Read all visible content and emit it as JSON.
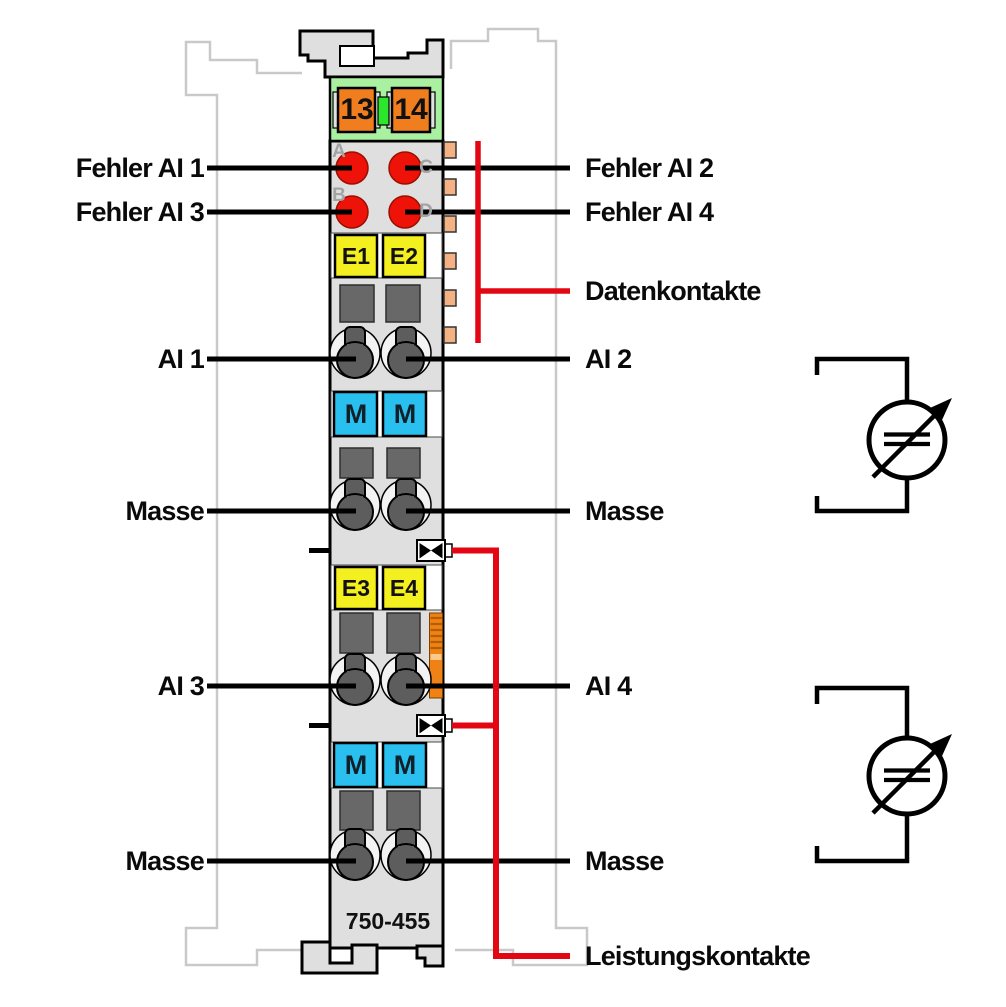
{
  "diagram": {
    "title_part_number": "750-455",
    "left_labels": {
      "fehler_ai_1": "Fehler AI 1",
      "fehler_ai_3": "Fehler AI 3",
      "ai_1": "AI 1",
      "masse_1": "Masse",
      "ai_3": "AI 3",
      "masse_2": "Masse"
    },
    "right_labels": {
      "fehler_ai_2": "Fehler AI 2",
      "fehler_ai_4": "Fehler AI 4",
      "datenkontakte": "Datenkontakte",
      "ai_2": "AI 2",
      "masse_1": "Masse",
      "ai_4": "AI 4",
      "masse_2": "Masse",
      "leistungskontakte": "Leistungskontakte"
    },
    "module": {
      "part_number": "750-455",
      "power_feed_terminals": {
        "left": "13",
        "right": "14"
      },
      "led_labels": {
        "a": "A",
        "b": "B",
        "c": "C",
        "d": "D"
      },
      "input_markers": {
        "e1": "E1",
        "e2": "E2",
        "e3": "E3",
        "e4": "E4"
      },
      "ground_markers": {
        "m1": "M",
        "m2": "M",
        "m3": "M",
        "m4": "M"
      }
    },
    "icons": {
      "current_source": "adjustable-dc-source-icon",
      "power_jumper": "power-jumper-contact-icon",
      "data_contact": "data-contact-tab-icon",
      "release_latch": "release-latch-icon"
    },
    "colors": {
      "accent_red": "#e30613",
      "led_red": "#ee1209",
      "connector_green": "#a9f1a1",
      "jumper_green": "#2ce62c",
      "terminal_orange": "#f07d1e",
      "marker_yellow": "#f4ef1f",
      "marker_cyan": "#29c0ef",
      "clamp_gray": "#5d5d5d",
      "component_gray": "#686868",
      "body_gray": "#dfdfdf",
      "ghost_gray": "#c9c9c9",
      "data_contact_peach": "#f4b183",
      "latch_orange": "#f08114"
    }
  }
}
